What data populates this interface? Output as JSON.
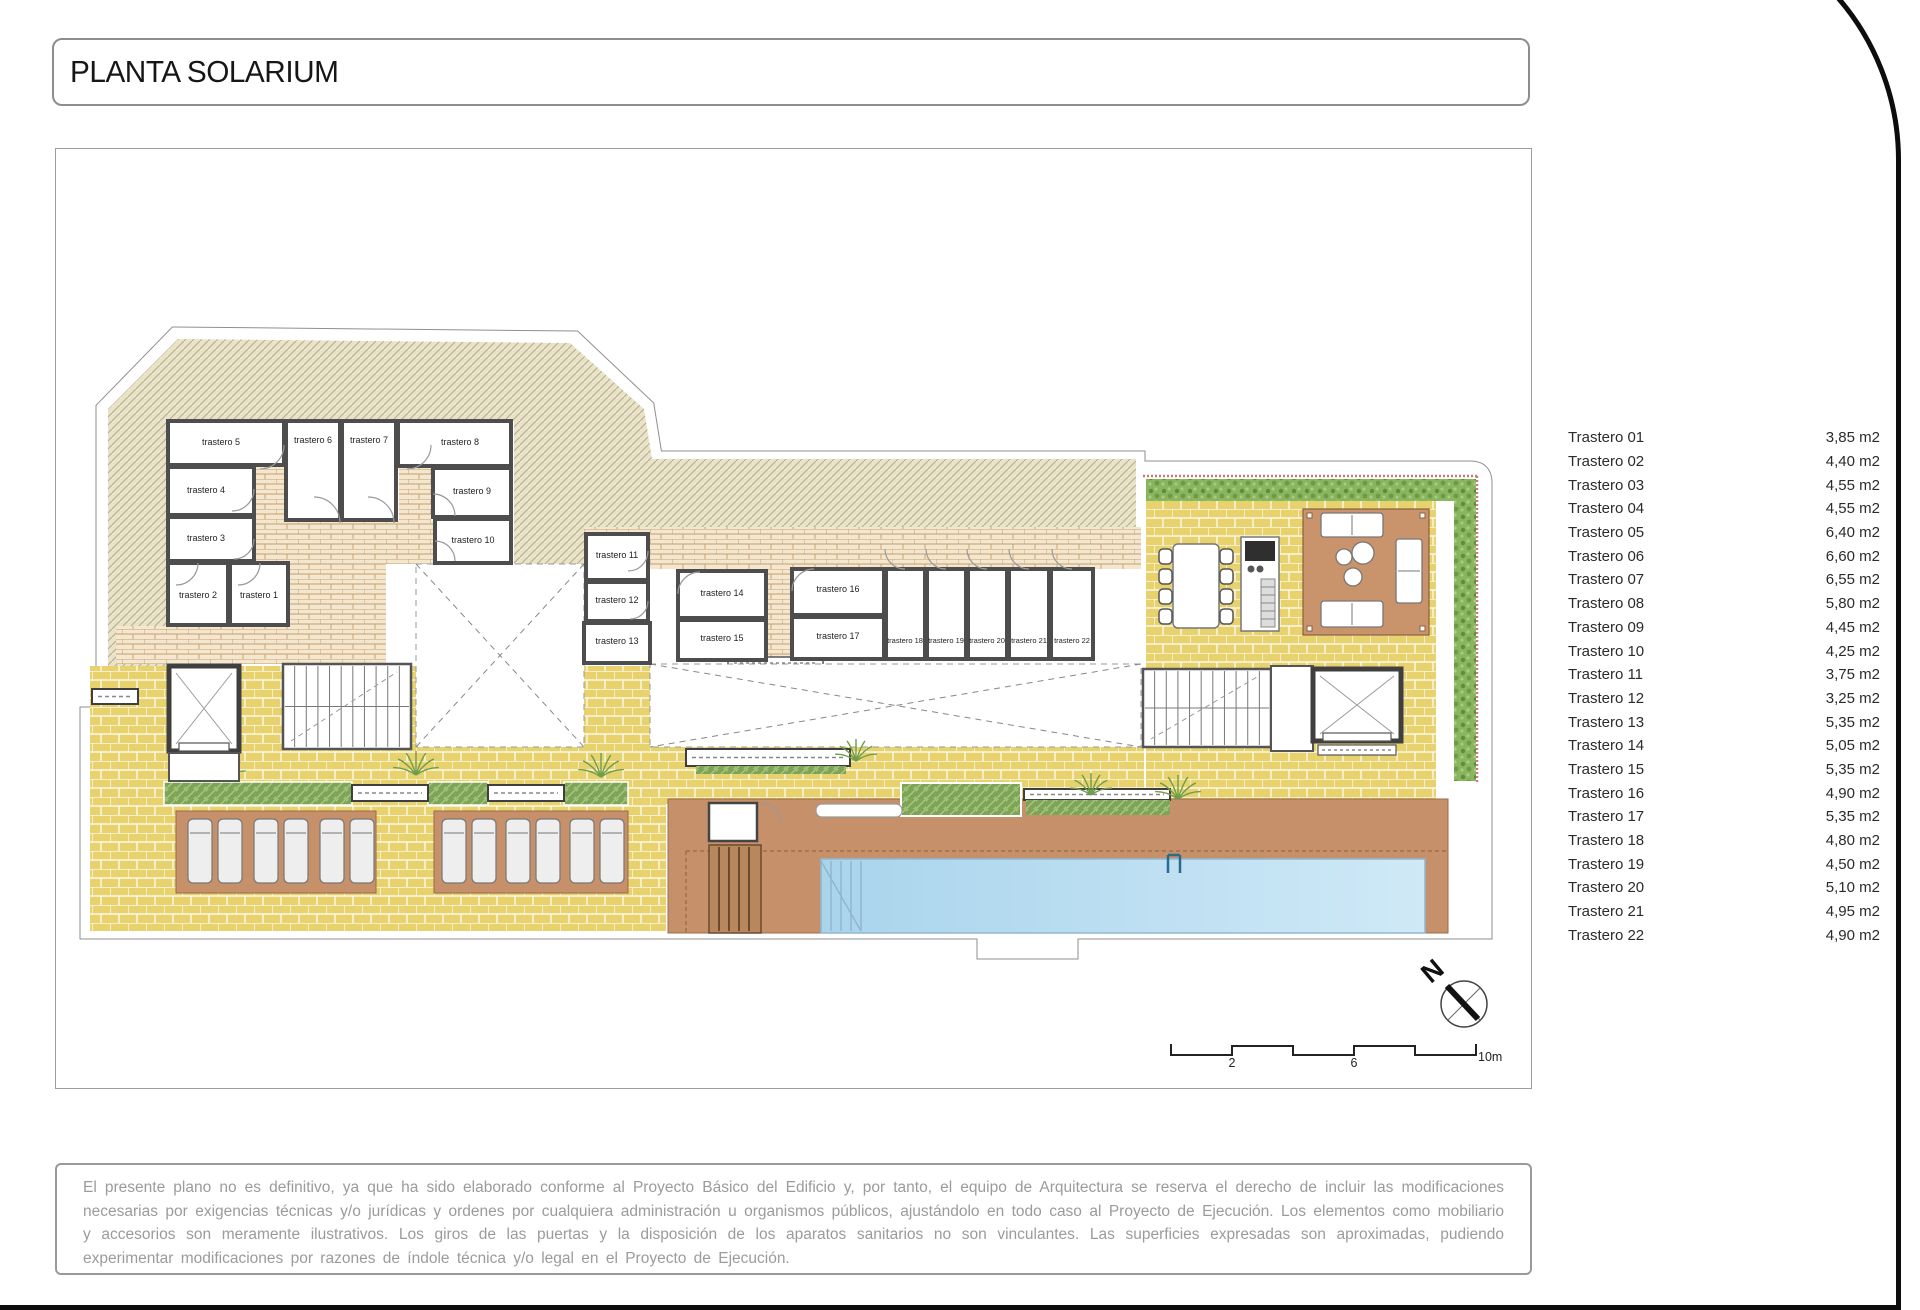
{
  "title": "PLANTA SOLARIUM",
  "legend": {
    "rows": [
      {
        "name": "Trastero 01",
        "area": "3,85 m2"
      },
      {
        "name": "Trastero 02",
        "area": "4,40 m2"
      },
      {
        "name": "Trastero 03",
        "area": "4,55 m2"
      },
      {
        "name": "Trastero 04",
        "area": "4,55 m2"
      },
      {
        "name": "Trastero 05",
        "area": "6,40 m2"
      },
      {
        "name": "Trastero 06",
        "area": "6,60 m2"
      },
      {
        "name": "Trastero 07",
        "area": "6,55 m2"
      },
      {
        "name": "Trastero 08",
        "area": "5,80 m2"
      },
      {
        "name": "Trastero 09",
        "area": "4,45 m2"
      },
      {
        "name": "Trastero 10",
        "area": "4,25 m2"
      },
      {
        "name": "Trastero 11",
        "area": "3,75 m2"
      },
      {
        "name": "Trastero 12",
        "area": "3,25 m2"
      },
      {
        "name": "Trastero 13",
        "area": "5,35 m2"
      },
      {
        "name": "Trastero 14",
        "area": "5,05 m2"
      },
      {
        "name": "Trastero 15",
        "area": "5,35 m2"
      },
      {
        "name": "Trastero 16",
        "area": "4,90 m2"
      },
      {
        "name": "Trastero 17",
        "area": "5,35 m2"
      },
      {
        "name": "Trastero 18",
        "area": "4,80 m2"
      },
      {
        "name": "Trastero 19",
        "area": "4,50 m2"
      },
      {
        "name": "Trastero 20",
        "area": "5,10 m2"
      },
      {
        "name": "Trastero 21",
        "area": "4,95 m2"
      },
      {
        "name": "Trastero 22",
        "area": "4,90 m2"
      }
    ]
  },
  "plan": {
    "rooms": [
      "trastero 1",
      "trastero 2",
      "trastero 3",
      "trastero 4",
      "trastero 5",
      "trastero 6",
      "trastero 7",
      "trastero 8",
      "trastero 9",
      "trastero 10",
      "trastero 11",
      "trastero 12",
      "trastero 13",
      "trastero 14",
      "trastero 15",
      "trastero 16",
      "trastero 17",
      "trastero 18",
      "trastero 19",
      "trastero 20",
      "trastero 21",
      "trastero 22"
    ],
    "north_label": "N",
    "scale_labels": [
      "2",
      "6",
      "10m"
    ]
  },
  "disclaimer": "El presente plano no es definitivo, ya que ha sido elaborado conforme al Proyecto Básico del Edificio y, por tanto, el equipo de Arquitectura se reserva el derecho de incluir las modificaciones necesarias por exigencias técnicas y/o jurídicas y ordenes por cualquiera administración u organismos públicos, ajustándolo en todo caso al Proyecto de Ejecución. Los elementos como mobiliario y accesorios son meramente ilustrativos. Los giros de las puertas y la disposición de los aparatos sanitarios no son vinculantes. Las superficies expresadas son aproximadas, pudiendo experimentar modificaciones por razones de índole técnica y/o legal en el Proyecto de Ejecución.",
  "colors": {
    "paving_yellow": "#e7d26d",
    "brick_beige": "#f3e7cf",
    "roof_hatch": "#e9e3c9",
    "hedge_green": "#8ab55f",
    "deck_brown": "#c6906a",
    "pool_blue": "#aed7ee",
    "wall_gray": "#4d4d4d",
    "frame_black": "#0d0d0d",
    "disclaimer_gray": "#9b9b9b"
  }
}
